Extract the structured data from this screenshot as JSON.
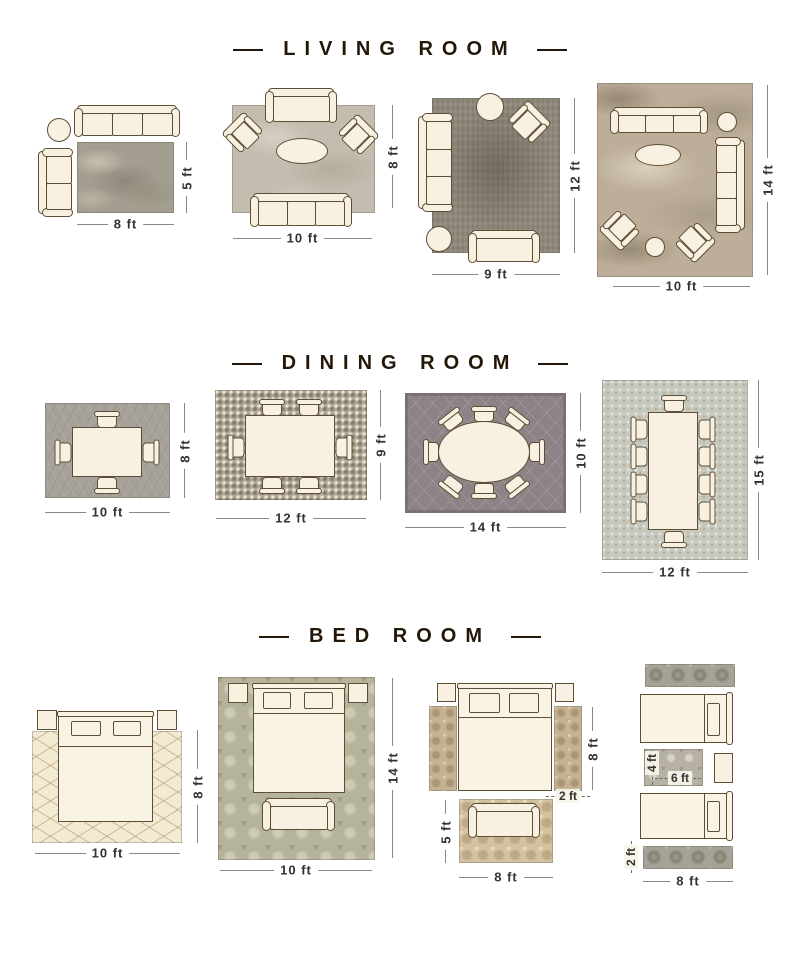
{
  "palette": {
    "furniture_fill": "#f8f1e1",
    "furniture_outline": "#5e4e35",
    "title_color": "#241708",
    "dimension_text": "#35322d"
  },
  "sections": {
    "living": {
      "title": "LIVING ROOM",
      "l1": {
        "w": "8 ft",
        "h": "5 ft"
      },
      "l2": {
        "w": "10 ft",
        "h": "8 ft"
      },
      "l3": {
        "w": "9 ft",
        "h": "12 ft"
      },
      "l4": {
        "w": "10 ft",
        "h": "14 ft"
      }
    },
    "dining": {
      "title": "DINING ROOM",
      "l1": {
        "w": "10 ft",
        "h": "8 ft"
      },
      "l2": {
        "w": "12 ft",
        "h": "9 ft"
      },
      "l3": {
        "w": "14 ft",
        "h": "10 ft"
      },
      "l4": {
        "w": "12 ft",
        "h": "15 ft"
      }
    },
    "bed": {
      "title": "BED ROOM",
      "l1": {
        "w": "10 ft",
        "h": "8 ft"
      },
      "l2": {
        "w": "10 ft",
        "h": "14 ft"
      },
      "l3": {
        "bed_h": "8 ft",
        "runner_w": "2 ft",
        "rug_w": "8 ft",
        "rug_h": "5 ft"
      },
      "l4": {
        "small_rug_h": "4 ft",
        "small_rug_w": "6 ft",
        "runner_h": "2 ft",
        "runner_w": "8 ft"
      }
    }
  }
}
